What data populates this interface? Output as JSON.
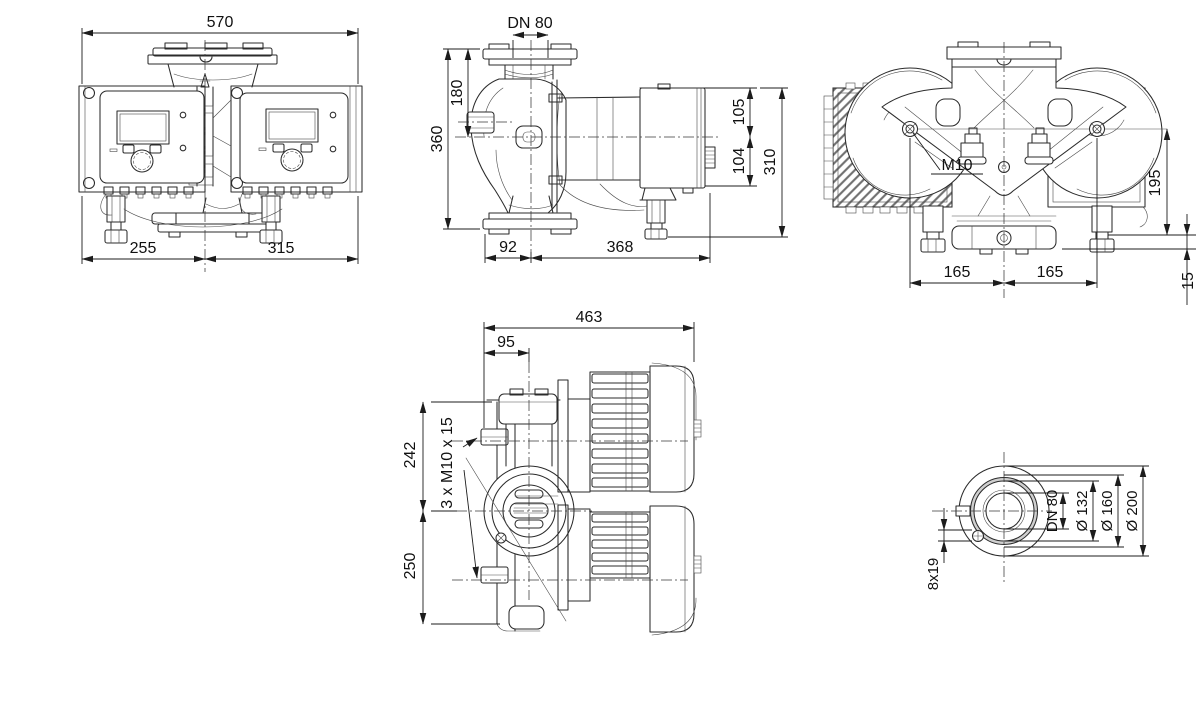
{
  "drawing": {
    "kind": "technical-dimensional-drawing",
    "subject": "twin-head inline circulator pump, five orthographic views",
    "background": "#ffffff",
    "line_color": "#2b2b2b",
    "views": {
      "front": {
        "name": "front view",
        "dims": {
          "overall_width": "570",
          "center_to_left": "255",
          "center_to_right": "315"
        }
      },
      "side": {
        "name": "side view",
        "dims": {
          "nominal_diameter": "DN 80",
          "flange_to_axis": "180",
          "port_to_port": "360",
          "axis_to_motor_top": "105",
          "axis_to_motor_bottom": "104",
          "motor_overall_height": "310",
          "axis_to_flange_edge": "92",
          "axis_to_motor_end": "368"
        }
      },
      "top": {
        "name": "top view",
        "dims": {
          "screw_thread": "M10",
          "screws_to_flange": "195",
          "screw_to_center_left": "165",
          "screw_to_center_right": "165",
          "flange_offset": "15"
        }
      },
      "bottom": {
        "name": "bottom view",
        "dims": {
          "overall_length": "463",
          "edge_to_axis": "95",
          "axis_to_top": "242",
          "axis_to_bottom": "250",
          "fixing_screws": "3 x M10 x 15"
        }
      },
      "flange": {
        "name": "flange detail",
        "dims": {
          "nominal_diameter": "DN 80",
          "raised_face": "Ø 132",
          "bolt_circle": "Ø 160",
          "outer_diameter": "Ø 200",
          "bolt_holes": "8x19"
        }
      }
    }
  }
}
